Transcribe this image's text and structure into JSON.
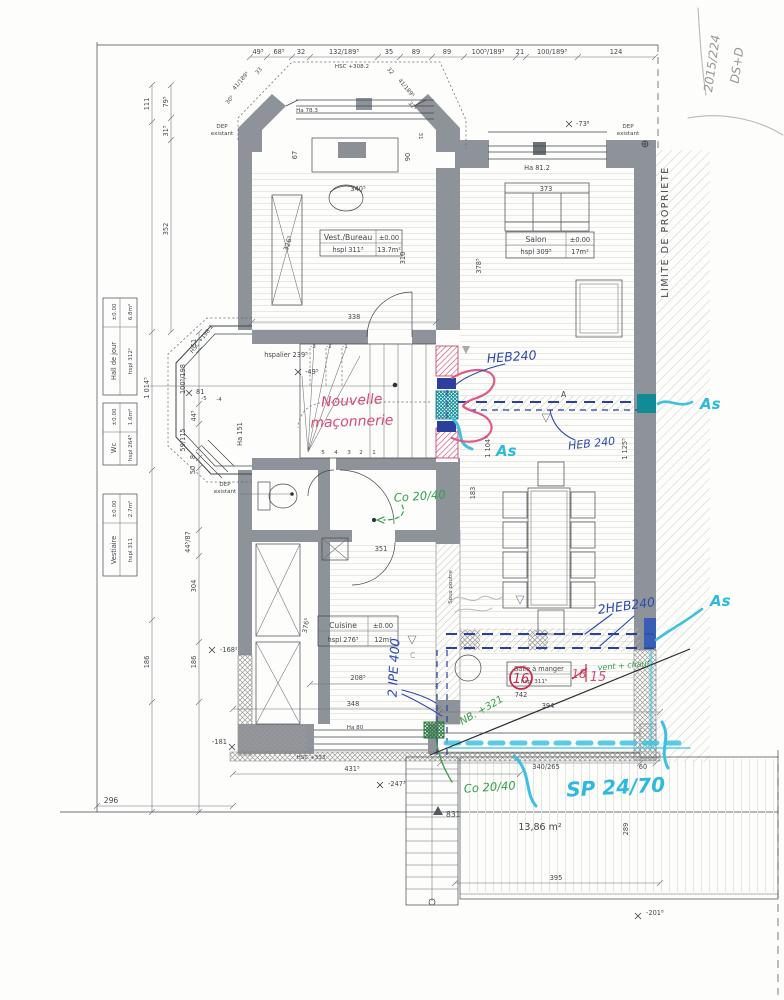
{
  "meta": {
    "corner_ref": "2015/224",
    "corner_initials": "DS+D"
  },
  "dims": {
    "top": [
      "49⁵",
      "68⁵",
      "32",
      "132/189⁵",
      "35",
      "89",
      "89",
      "100⁵/189³",
      "21",
      "100/189³",
      "124"
    ],
    "top_hsc": "HSC +308.2",
    "bay_left": [
      "41/189⁵",
      "33",
      "30⁵"
    ],
    "bay_right": [
      "32",
      "41/189⁵",
      "32⁵",
      "31"
    ],
    "left": {
      "v111": "111",
      "v79": "79⁵",
      "v31": "31⁵",
      "v352": "352",
      "v1014": "1 014⁵",
      "v51": "51",
      "v100": "100⁵/198",
      "v44": "44⁵",
      "v59": "59/115",
      "v8": "8",
      "v50": "50",
      "v44b": "44⁵/87",
      "v304": "304",
      "v186a": "186",
      "v186b": "186",
      "v296": "296"
    },
    "interior": {
      "v67": "67",
      "v90": "90",
      "c340": "340⁵",
      "h373": "373",
      "d326": "326⁵",
      "v310": "310",
      "h338": "338",
      "v378": "378⁵",
      "v1104": "1 104⁵",
      "v1125": "1 125⁵",
      "v183": "183",
      "h351": "351",
      "v376": "376⁵",
      "h208": "208⁵",
      "h348": "348",
      "h394": "394",
      "h742": "742",
      "h340265": "340/265",
      "h60": "60",
      "h431": "431⁵",
      "h395": "395",
      "v289": "289"
    }
  },
  "levels": {
    "m73": "-73⁸",
    "m49": "-49⁵",
    "m81": "81",
    "m168": "-168²",
    "m181": "-181",
    "m247": "-247³",
    "m201": "-201⁸",
    "p831": "831"
  },
  "heights": {
    "ha783": "Ha 78.3",
    "ha812": "Ha 81.2",
    "ha151": "Ha 151",
    "ha80": "Ha 80",
    "hsc198": "HSC +198.2",
    "hsc333": "HSC +333",
    "hspalier": "hspalier 239⁵",
    "sous_poutre": "Sous poutre"
  },
  "labels": {
    "dep": "DEP",
    "existant": "existant",
    "limite": "LIMITE DE PROPRIETE",
    "terrace_area": "13,86 m²",
    "a": "A",
    "c": "C"
  },
  "rooms": {
    "bureau": {
      "name": "Vest./Bureau",
      "level": "±0.00",
      "hspl": "hspl 311³",
      "area": "13.7m²"
    },
    "salon": {
      "name": "Salon",
      "level": "±0.00",
      "hspl": "hspl 309⁵",
      "area": "17m²"
    },
    "hall": {
      "name": "Hall de jour",
      "level": "±0.00",
      "hspl": "hspl 312¹",
      "area": "6.8m²"
    },
    "wc": {
      "name": "Wc",
      "level": "±0.00",
      "hspl": "hspl 264⁵",
      "area": "1.6m²"
    },
    "vestiaire": {
      "name": "Vestiaire",
      "level": "±0.00",
      "hspl": "hspl 311",
      "area": "2.7m²"
    },
    "cuisine": {
      "name": "Cuisine",
      "level": "±0.00",
      "hspl": "hspl 276⁵",
      "area": "12m²"
    },
    "salle": {
      "name": "Salle à manger",
      "hspl": "hspl 311⁵"
    }
  },
  "stairs": {
    "neg": [
      "-3",
      "-2",
      "-1"
    ],
    "pos": [
      "5",
      "4",
      "3",
      "2",
      "1"
    ],
    "entry": [
      "-5",
      "-4"
    ]
  },
  "annotations": {
    "red": {
      "line1": "Nouvelle",
      "line2": "maçonnerie",
      "circle": "16",
      "rev1": "18",
      "rev2": "15"
    },
    "blue": {
      "heb_top": "HEB240",
      "heb_mid": "HEB 240",
      "heb2": "2HEB240",
      "ipe": "2 IPE 400"
    },
    "cyan": {
      "as1": "As",
      "as2": "As",
      "as3": "As",
      "sp": "SP 24/70"
    },
    "green": {
      "co1": "Co 20/40",
      "co2": "Co 20/40",
      "nb": "NB. +321",
      "vent": "vent + chauf."
    },
    "colors": {
      "blue": "#2b49ae",
      "cyan": "#2fb9de",
      "red": "#d84a74",
      "green": "#33a04a",
      "teal": "#13929e",
      "pencil": "#97978f"
    }
  }
}
